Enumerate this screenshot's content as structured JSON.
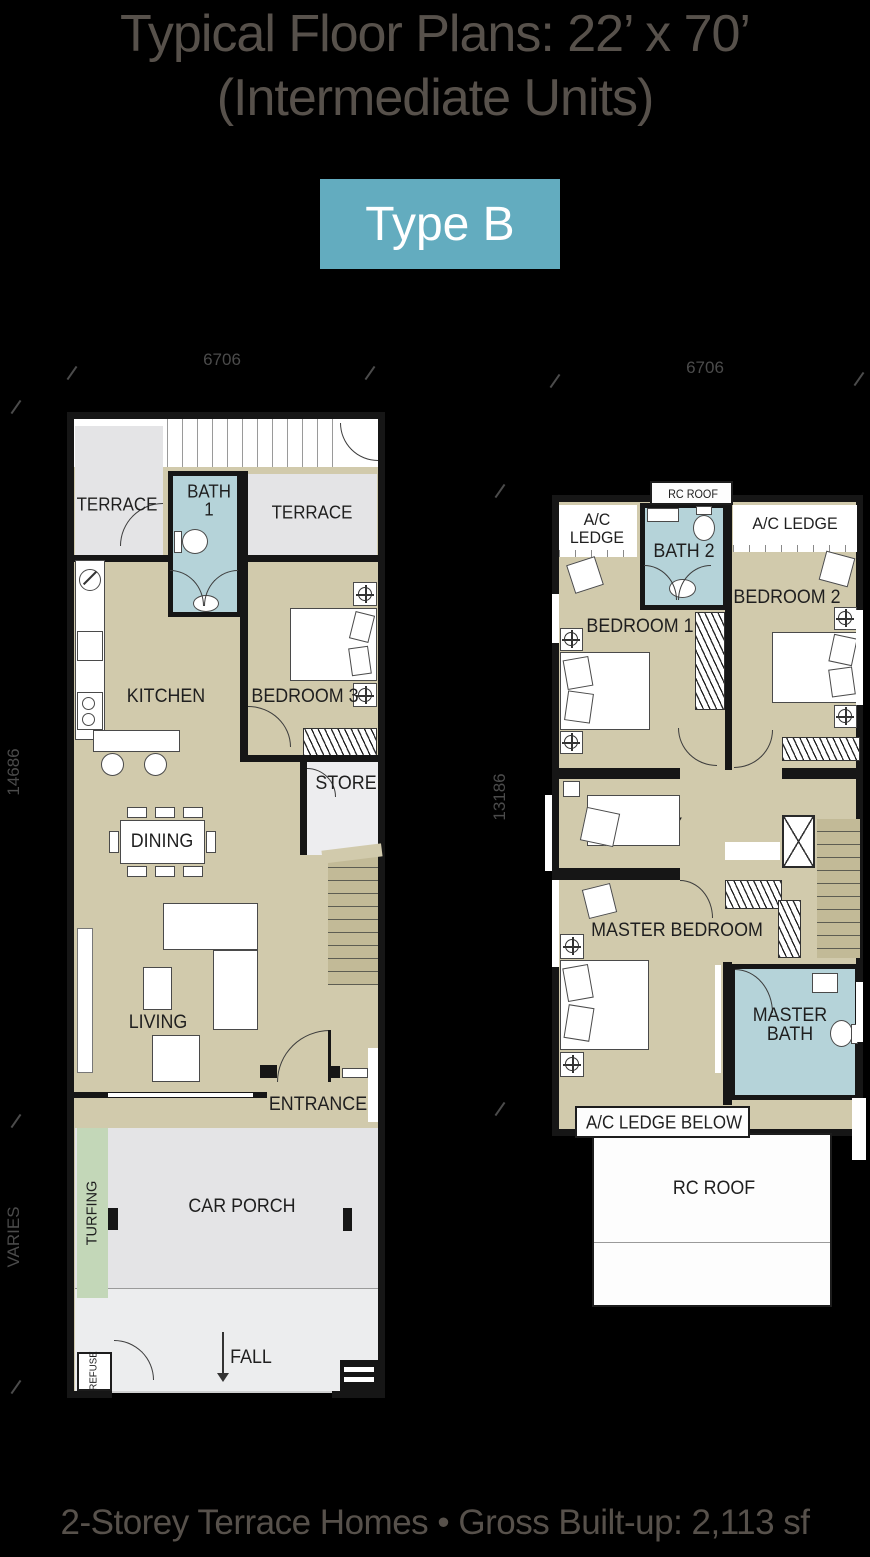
{
  "title": {
    "line1": "Typical Floor Plans: 22’ x 70’",
    "line2": "(Intermediate Units)"
  },
  "badge": "Type B",
  "caption": "2-Storey Terrace Homes • Gross Built-up: 2,113 sf",
  "colors": {
    "badge": "#63acbf",
    "text": "#57514b",
    "wall": "#161616",
    "beige": "#d1caac",
    "terrace": "#e4e4e6",
    "bath": "#b5d3d9",
    "turf": "#c3d7b8",
    "stair": "#c2ba97"
  },
  "ground_floor": {
    "dim_top": "6706",
    "dim_left": "14686",
    "dim_left_lower": "VARIES",
    "labels": {
      "terrace_left": "TERRACE",
      "terrace_right": "TERRACE",
      "bath1": [
        "BATH",
        "1"
      ],
      "kitchen": "KITCHEN",
      "bedroom3": "BEDROOM 3",
      "store": "STORE",
      "dining": "DINING",
      "living": "LIVING",
      "entrance": "ENTRANCE",
      "car_porch": "CAR PORCH",
      "turfing": "TURFING",
      "fall": "FALL",
      "refuse": "REFUSE"
    }
  },
  "first_floor": {
    "dim_top": "6706",
    "dim_left": "13186",
    "labels": {
      "rc_roof_top": "RC ROOF",
      "ac_ledge_left": [
        "A/C",
        "LEDGE"
      ],
      "ac_ledge_right": "A/C LEDGE",
      "bath2": "BATH 2",
      "bedroom1": "BEDROOM 1",
      "bedroom2": "BEDROOM 2",
      "study": "STUDY",
      "master_bedroom": "MASTER BEDROOM",
      "master_bath": [
        "MASTER",
        "BATH"
      ],
      "ac_ledge_below": "A/C LEDGE BELOW",
      "rc_roof": "RC ROOF"
    }
  }
}
